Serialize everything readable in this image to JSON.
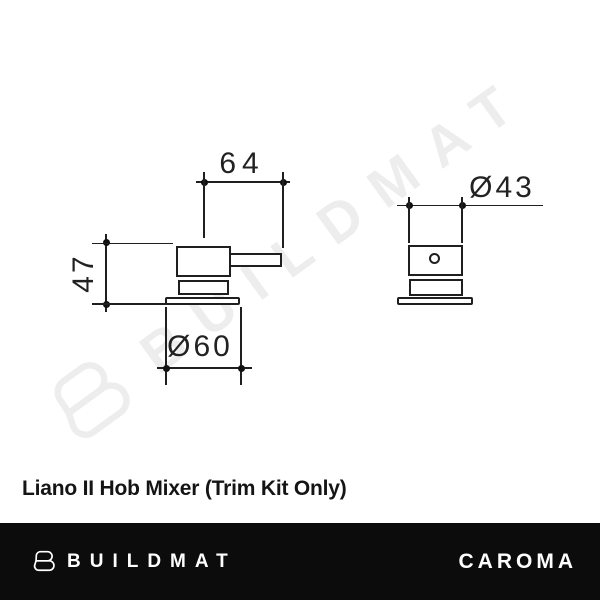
{
  "watermark": {
    "label": "BUILDMAT"
  },
  "diagram": {
    "left_view": {
      "width_label": "64",
      "height_label": "47",
      "base_diameter_label": "Ø60"
    },
    "right_view": {
      "diameter_label": "Ø43"
    }
  },
  "product": {
    "title": "Liano II Hob Mixer (Trim Kit Only)"
  },
  "footer": {
    "left_brand": "BUILDMAT",
    "right_brand": "CAROMA"
  },
  "colors": {
    "line": "#1f1f1f",
    "watermark": "#ededed",
    "footer_background": "#0c0c0c",
    "footer_text": "#ffffff"
  }
}
